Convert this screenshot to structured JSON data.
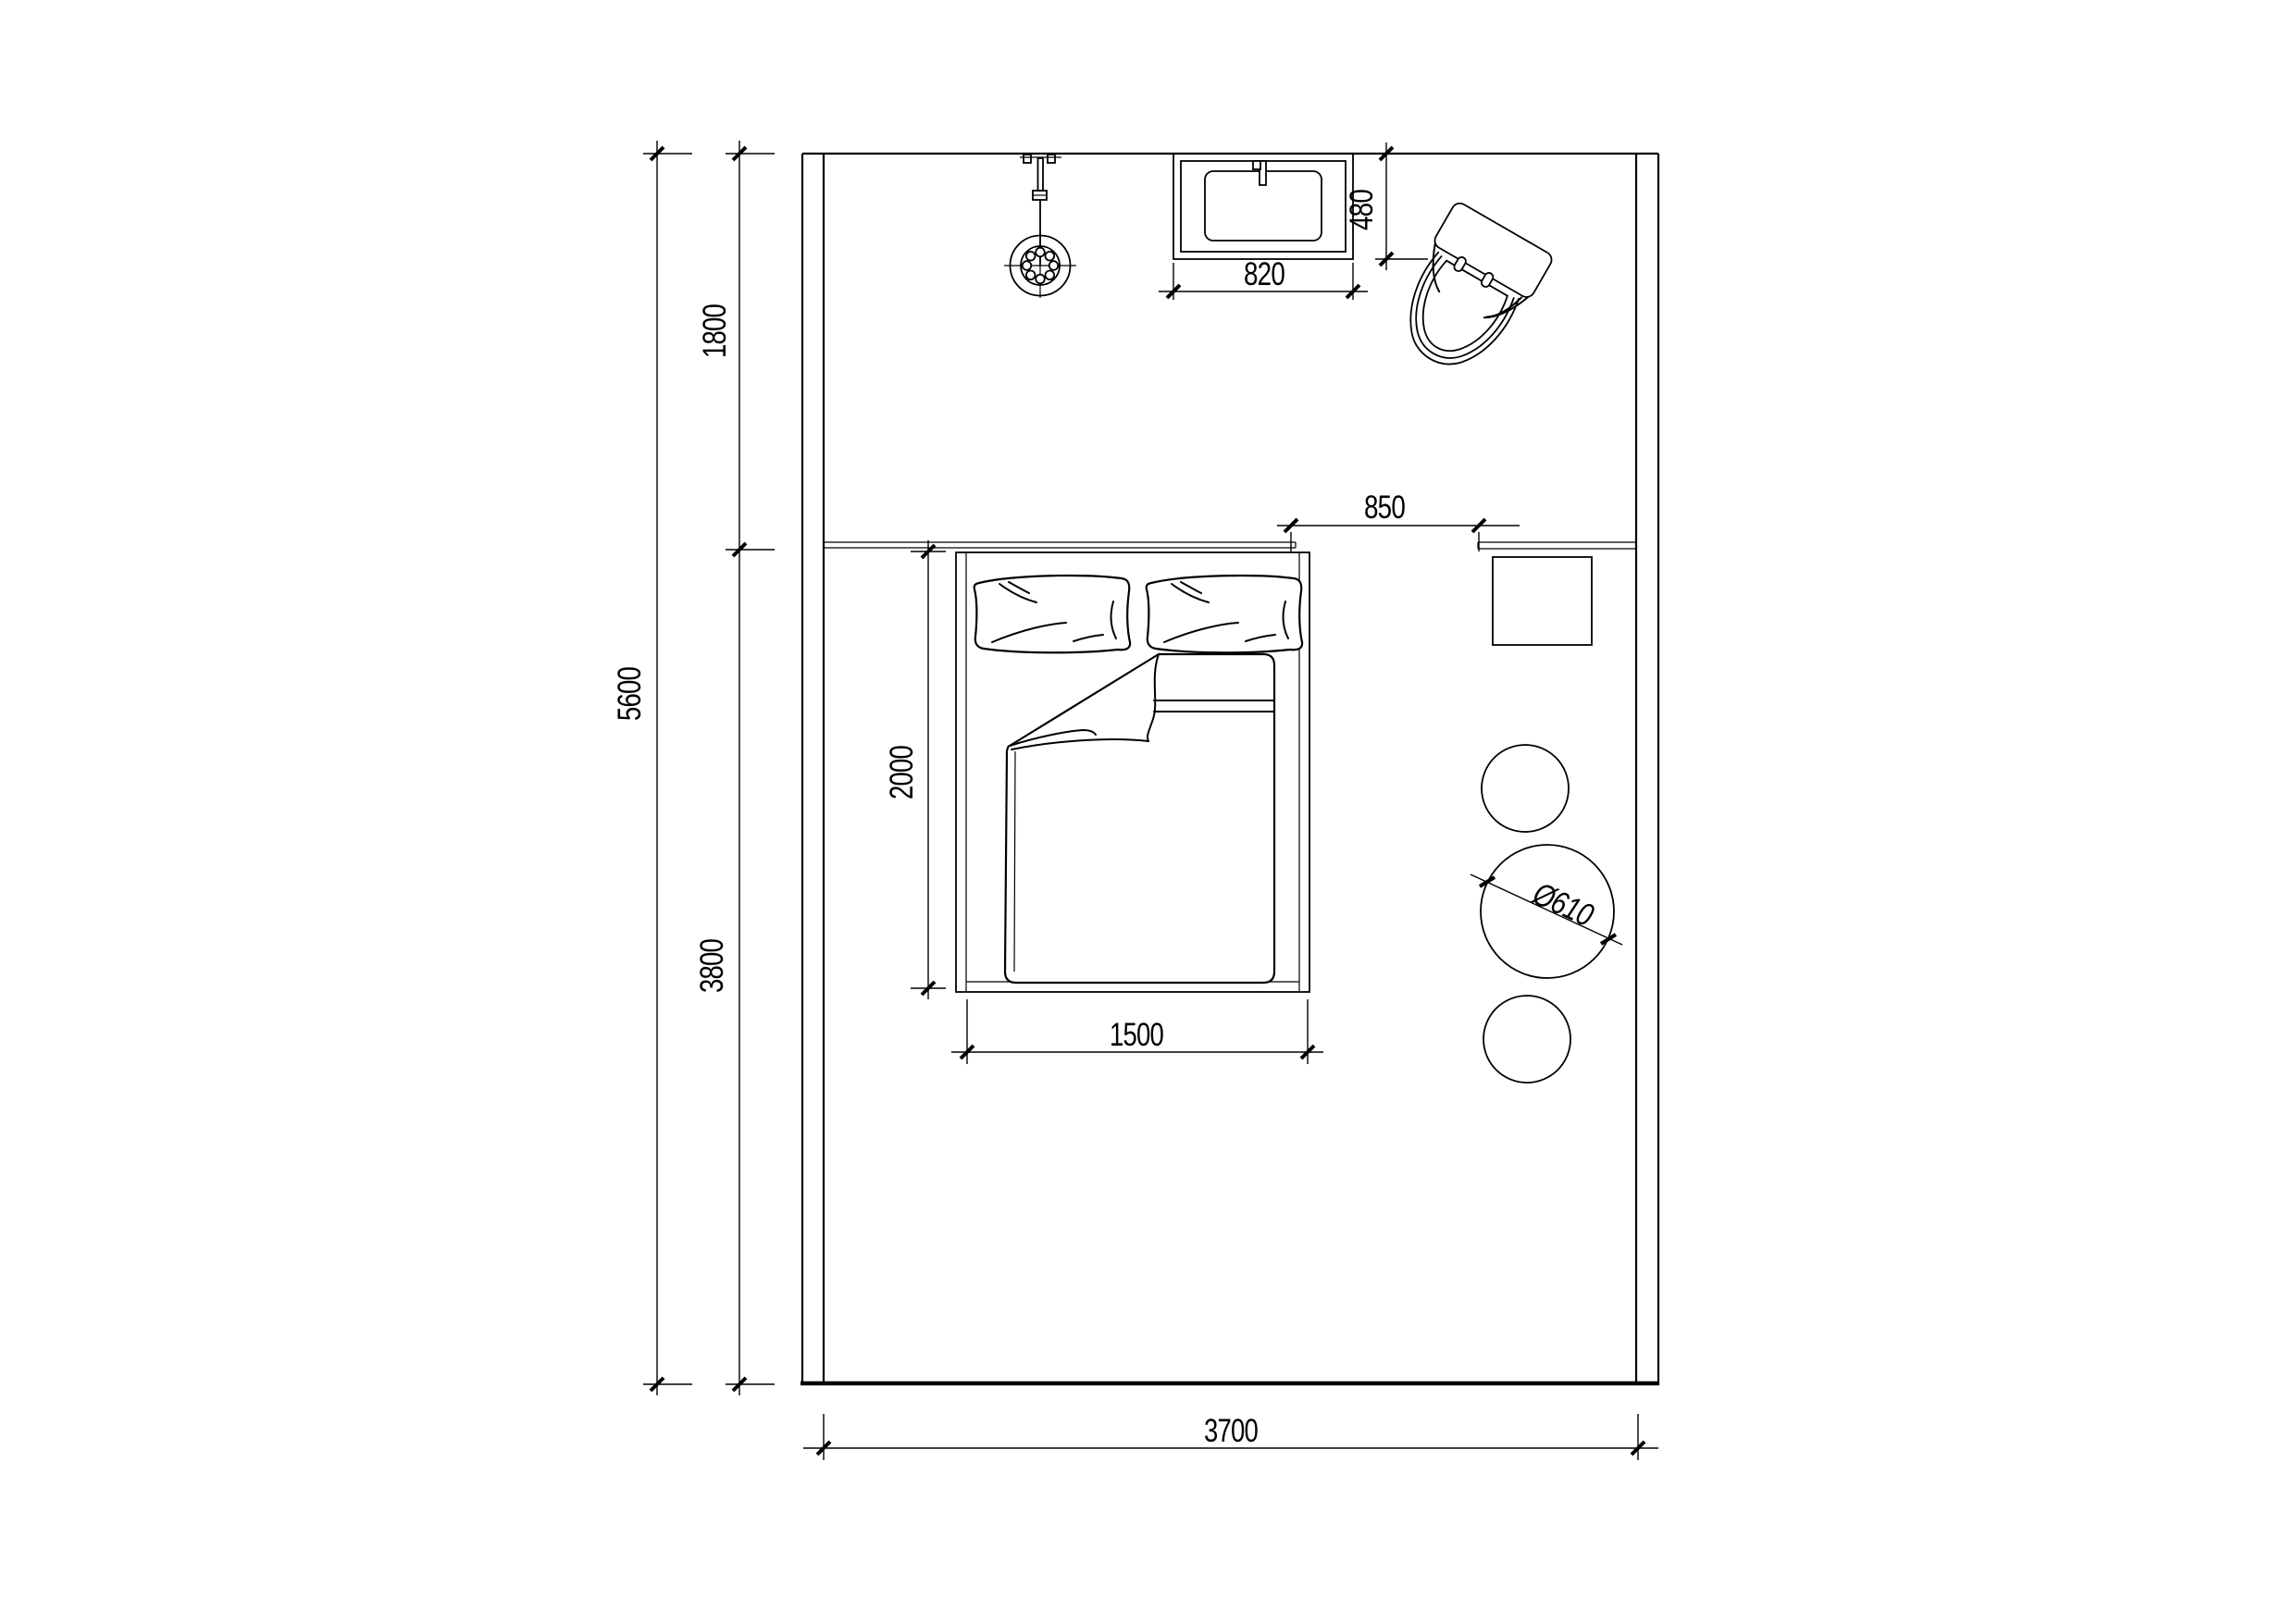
{
  "dimensions": {
    "total_height": "5600",
    "zone_top": "1800",
    "zone_bottom": "3800",
    "room_width": "3700",
    "bed_length": "2000",
    "bed_width": "1500",
    "shelf_gap": "850",
    "basin_width": "820",
    "basin_depth": "480",
    "table_diameter": "Ø610"
  },
  "colors": {
    "line": "#000000",
    "background": "#ffffff"
  }
}
